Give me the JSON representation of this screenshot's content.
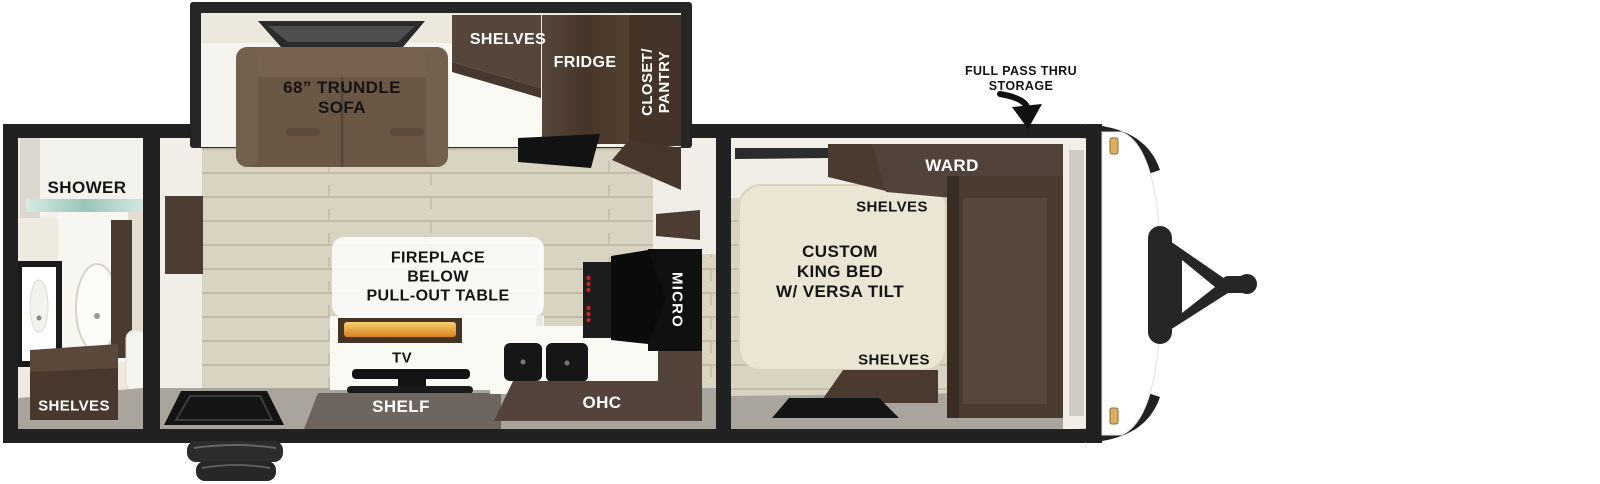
{
  "diagram": {
    "type": "travel-trailer-floorplan",
    "exterior": {
      "storage_label_line1": "FULL PASS THRU",
      "storage_label_line2": "STORAGE"
    },
    "bathroom": {
      "shower_label": "SHOWER",
      "shelves_label": "SHELVES"
    },
    "living_kitchen": {
      "sofa_label_line1": "68” TRUNDLE",
      "sofa_label_line2": "SOFA",
      "shelves_label": "SHELVES",
      "fridge_label": "FRIDGE",
      "closet_label_line1": "CLOSET/",
      "closet_label_line2": "PANTRY",
      "fireplace_label_line1": "FIREPLACE",
      "fireplace_label_line2": "BELOW",
      "fireplace_label_line3": "PULL-OUT TABLE",
      "tv_label": "TV",
      "shelf_label": "SHELF",
      "ohc_label": "OHC",
      "micro_label": "MICRO"
    },
    "bedroom": {
      "bed_label_line1": "CUSTOM",
      "bed_label_line2": "KING BED",
      "bed_label_line3": "W/ VERSA TILT",
      "wardrobe_label": "WARD",
      "shelves_top_label": "SHELVES",
      "shelves_bottom_label": "SHELVES"
    },
    "colors": {
      "wall_black": "#212121",
      "floor_plank": "#d9d3c1",
      "floor_gray": "#a9a59c",
      "sofa_brown": "#6b5746",
      "cabinet_dark_brown": "#4a3a30",
      "bed_cream": "#ebe6d4",
      "fire_accent": "#d8821f",
      "marker_light": "#dcae62"
    }
  }
}
